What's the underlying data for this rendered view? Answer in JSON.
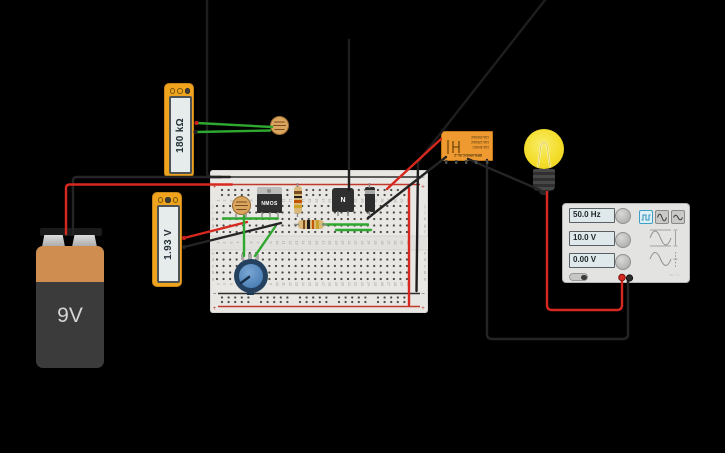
{
  "canvas": {
    "width": 725,
    "height": 453,
    "background": "#000000"
  },
  "colors": {
    "wire_red": "#d6281e",
    "wire_green": "#2fa82f",
    "wire_black": "#242424",
    "wire_faint": "#1e1e1e",
    "board": "#e9e7e3",
    "rail_red": "#c0392b",
    "rail_black": "#2e2e2e",
    "meter_yellow": "#f0a31d",
    "relay_orange": "#ef9a30",
    "bulb_yellow": "#f4dd2b",
    "selected_blue": "#3f9ec4"
  },
  "battery": {
    "label": "9V"
  },
  "multimeters": [
    {
      "value": "180 kΩ",
      "mode": "resistance",
      "buttons": [
        "amps",
        "volts",
        "ohms"
      ],
      "selected_button": 2
    },
    {
      "value": "1.93 V",
      "mode": "voltage",
      "buttons": [
        "amps",
        "volts",
        "ohms"
      ],
      "selected_button": 1
    }
  ],
  "breadboard": {
    "columns": 30,
    "row_letters_top": [
      "j",
      "i",
      "h",
      "g",
      "f"
    ],
    "row_letters_bottom": [
      "e",
      "d",
      "c",
      "b",
      "a"
    ],
    "rail_negative_symbol": "−",
    "rail_positive_symbol": "+"
  },
  "components": {
    "mosfet_label": "NMOS",
    "transistor_label": "N",
    "resistor_vertical_bands": [
      "#7a4a21",
      "#1e1e1e",
      "#c45500",
      "#c9a227"
    ],
    "resistor_horizontal_bands": [
      "#7a4a21",
      "#1e1e1e",
      "#c45500",
      "#c9a227"
    ]
  },
  "relay": {
    "ratings": [
      "10A 250VAC",
      "10A 125VAC",
      "10A 30VDC"
    ],
    "model": "SRD-05VDC-SL-C"
  },
  "function_generator": {
    "frequency": "50.0 Hz",
    "amplitude": "10.0 V",
    "offset": "0.00 V",
    "waveforms": [
      "square",
      "sine",
      "triangle"
    ],
    "selected_waveform": "square",
    "logo": "⎓ ∿"
  }
}
